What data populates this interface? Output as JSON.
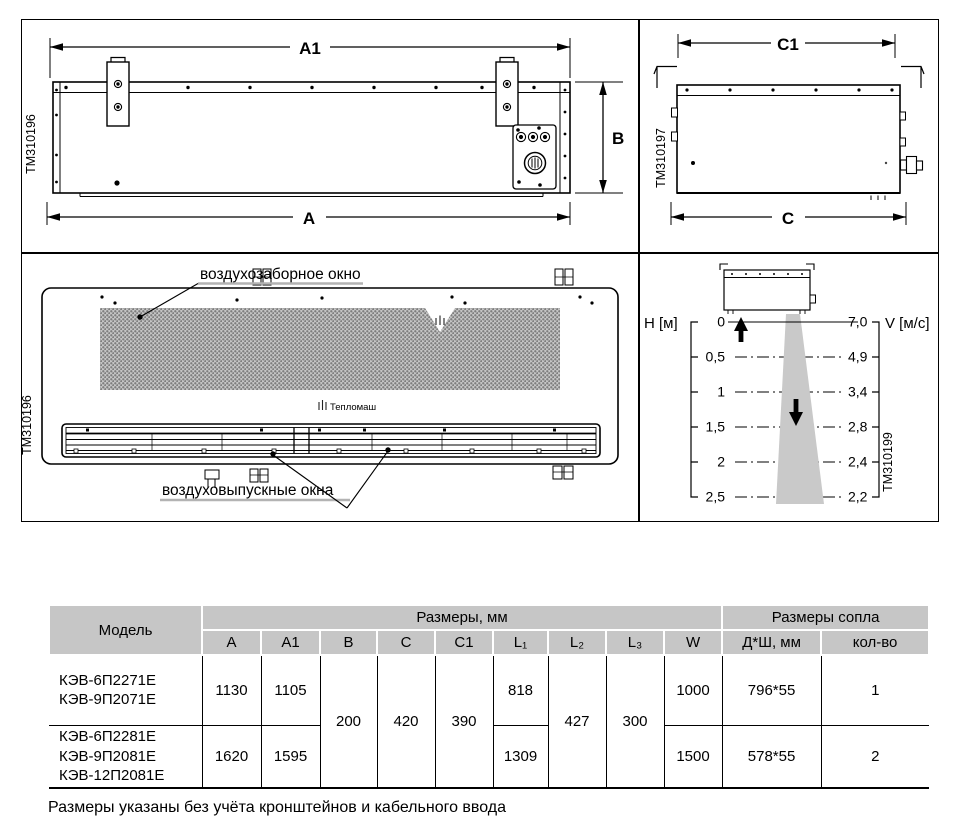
{
  "drawings": {
    "top_left": {
      "code": "TM310196",
      "dim_a1": "A1",
      "dim_a": "A",
      "dim_b": "B"
    },
    "top_right": {
      "code": "TM310197",
      "dim_c1": "C1",
      "dim_c": "C"
    },
    "bottom_left": {
      "code": "TM310196",
      "intake_label": "воздухозаборное окно",
      "outlet_label": "воздуховыпускные окна",
      "brand": "Тепломаш"
    },
    "flow_diagram": {
      "code": "TM310199",
      "h_axis_label": "H [м]",
      "v_axis_label": "V [м/с]",
      "h_ticks": [
        "0",
        "0,5",
        "1",
        "1,5",
        "2",
        "2,5"
      ],
      "v_ticks": [
        "7,0",
        "4,9",
        "3,4",
        "2,8",
        "2,4",
        "2,2"
      ]
    }
  },
  "chart_data": {
    "type": "line",
    "xlabel": "H [м]",
    "ylabel": "V [м/с]",
    "x": [
      0,
      0.5,
      1,
      1.5,
      2,
      2.5
    ],
    "y": [
      7.0,
      4.9,
      3.4,
      2.8,
      2.4,
      2.2
    ]
  },
  "table": {
    "header": {
      "model": "Модель",
      "dims_group": "Размеры, мм",
      "nozzle_group": "Размеры сопла",
      "col_a": "A",
      "col_a1": "A1",
      "col_b": "B",
      "col_c": "C",
      "col_c1": "C1",
      "col_l1": "L₁",
      "col_l2": "L₂",
      "col_l3": "L₃",
      "col_w": "W",
      "col_nozzle": "Д*Ш, мм",
      "col_count": "кол-во"
    },
    "shared": {
      "b": "200",
      "c": "420",
      "c1": "390",
      "l2": "427",
      "l3": "300"
    },
    "rows": [
      {
        "models": "КЭВ-6П2271Е\nКЭВ-9П2071Е",
        "a": "1130",
        "a1": "1105",
        "l1": "818",
        "w": "1000",
        "nozzle": "796*55",
        "count": "1"
      },
      {
        "models": "КЭВ-6П2281Е\nКЭВ-9П2081Е\nКЭВ-12П2081Е",
        "a": "1620",
        "a1": "1595",
        "l1": "1309",
        "w": "1500",
        "nozzle": "578*55",
        "count": "2"
      }
    ]
  },
  "footnote": "Размеры указаны без учёта кронштейнов и кабельного ввода",
  "colors": {
    "header_gray": "#c6c6c6",
    "cone_gray": "#c9c9c9",
    "hatch_gray": "#7e7e7e",
    "underline_gray": "#b3b3b3"
  }
}
